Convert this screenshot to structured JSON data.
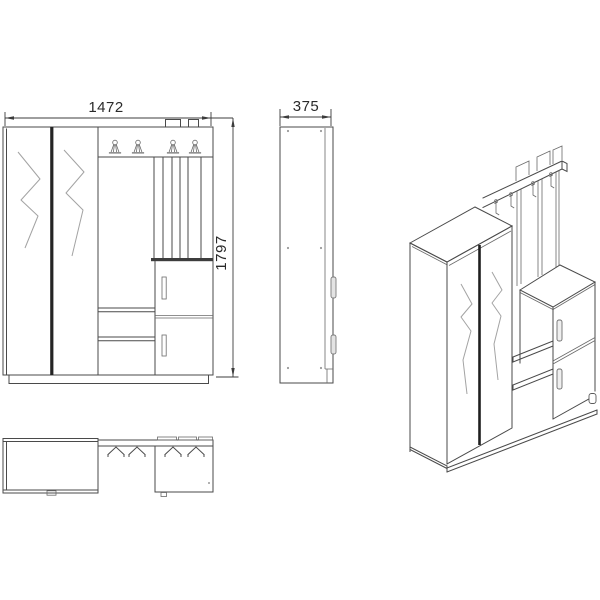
{
  "meta": {
    "background_color": "#ffffff",
    "line_color": "#4a4a4a",
    "dark_line_color": "#1f1f1f",
    "decor_line_color": "#a3a3a3",
    "text_color": "#2a2a2a"
  },
  "drawing": {
    "kind": "furniture-technical-drawing",
    "subject": "hallway wardrobe unit with coat rack, shelves and cabinet",
    "dimensions": {
      "width": "1472",
      "depth": "375",
      "height": "1797"
    },
    "views": {
      "front": {
        "label": "front-view",
        "hook_count": 4,
        "door_count": 2,
        "drawer_doors": 2,
        "shelf_count": 2
      },
      "side": {
        "label": "side-view",
        "handle_count": 2
      },
      "top": {
        "label": "top-plan-view",
        "hook_count": 4
      },
      "isometric": {
        "label": "isometric-view",
        "hook_count": 4,
        "slat_count": 3
      }
    }
  }
}
